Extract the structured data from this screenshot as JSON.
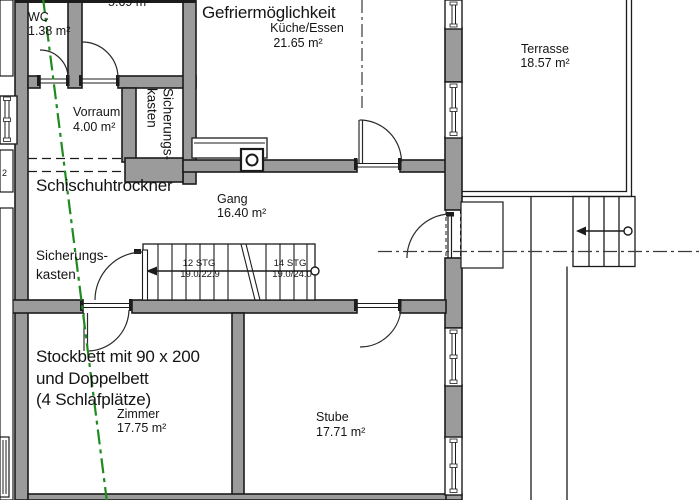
{
  "rooms": {
    "wc": {
      "name": "WC",
      "area": "1.38 m²"
    },
    "small_room": {
      "area": "5.69 m²"
    },
    "kitchen": {
      "banner": "Gefriermöglichkeit",
      "name": "Küche/Essen",
      "area": "21.65 m²"
    },
    "terrace": {
      "name": "Terrasse",
      "area": "18.57 m²"
    },
    "vorraum": {
      "name": "Vorraum",
      "area": "4.00 m²"
    },
    "hallway": {
      "name": "Gang",
      "area": "16.40 m²"
    },
    "zimmer": {
      "name": "Zimmer",
      "area": "17.75 m²",
      "note1": "Stockbett mit 90 x 200",
      "note2": "und Doppelbett",
      "note3": "(4 Schlafplätze)"
    },
    "stube": {
      "name": "Stube",
      "area": "17.71 m²"
    }
  },
  "annotations": {
    "ski_boot_dryer": "Schischuhtrockner",
    "fuse_box_line1": "Sicherungs-",
    "fuse_box_line2": "kasten",
    "edge_label_fragment": "2"
  },
  "stairs": {
    "run_left": {
      "count": "12 STG",
      "riser_tread": "19.0/22.9"
    },
    "run_right": {
      "count": "14 STG",
      "riser_tread": "19.0/24.0"
    }
  },
  "colors": {
    "wall_fill": "#9b9b9b",
    "line": "#1c1c1c",
    "section_line_green": "#1f8a1f"
  }
}
